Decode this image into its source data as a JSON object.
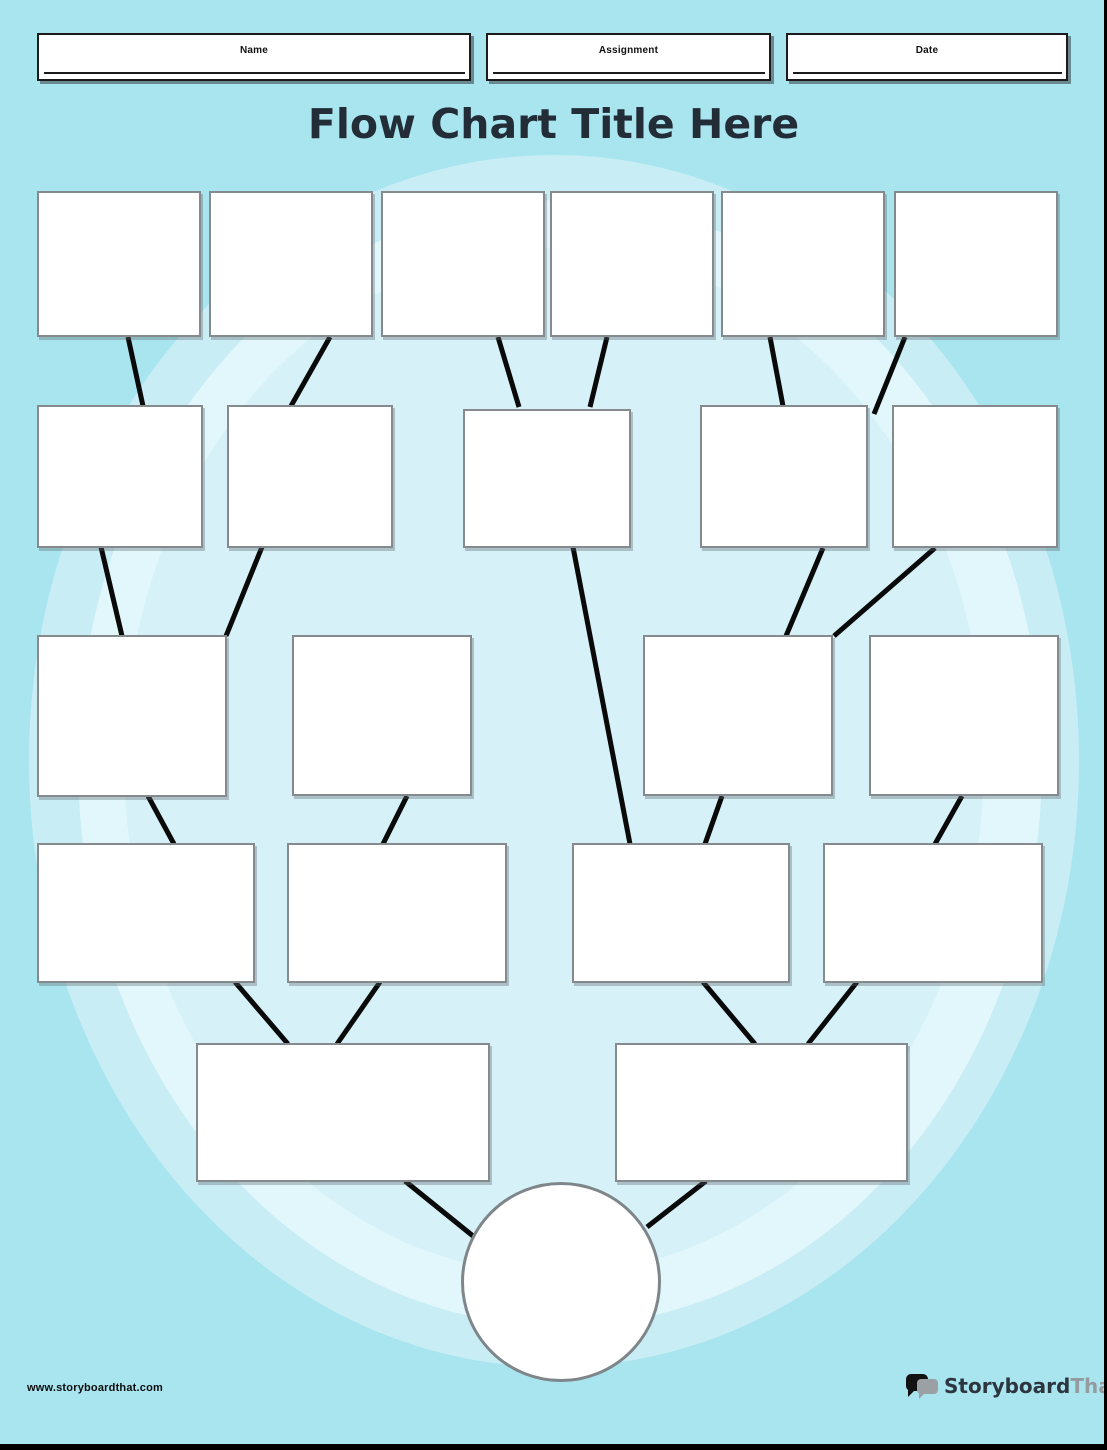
{
  "page": {
    "title": "Flow Chart Title Here"
  },
  "header": {
    "fields": [
      {
        "label": "Name"
      },
      {
        "label": "Assignment"
      },
      {
        "label": "Date"
      }
    ]
  },
  "footer": {
    "website": "www.storyboardthat.com",
    "logo": {
      "part1": "Storyboard",
      "part2": "That",
      "icon": "speech-bubbles-icon"
    }
  },
  "colors": {
    "background_outer": "#a9e5ef",
    "background_ring_medium": "#c9edf5",
    "background_ring_light": "#e1f7fb",
    "background_inner": "#d6f2f8",
    "node_fill": "#ffffff",
    "node_border": "#848a8d",
    "connector": "#0a0a0a",
    "title_text": "#222d38"
  },
  "flowchart": {
    "node_shape": "rectangle",
    "terminal_shape": "circle",
    "nodes_per_row": [
      6,
      5,
      4,
      4,
      2
    ],
    "all_nodes_empty": true,
    "edges": [
      "r1n1-r2n1",
      "r1n2-r2n2",
      "r1n3-r2n3",
      "r1n4-r2n3",
      "r1n5-r2n4",
      "r1n6-r2n4",
      "r2n1-r3n1",
      "r2n2-r3n1",
      "r2n3-r4n3",
      "r2n4-r3n3",
      "r2n5-r3n3",
      "r3n1-r4n1",
      "r3n2-r4n2",
      "r3n3-r4n3",
      "r3n4-r4n4",
      "r4n1-r5n1",
      "r4n2-r5n1",
      "r4n3-r5n2",
      "r4n4-r5n2",
      "r5n1-terminal",
      "r5n2-terminal"
    ]
  }
}
